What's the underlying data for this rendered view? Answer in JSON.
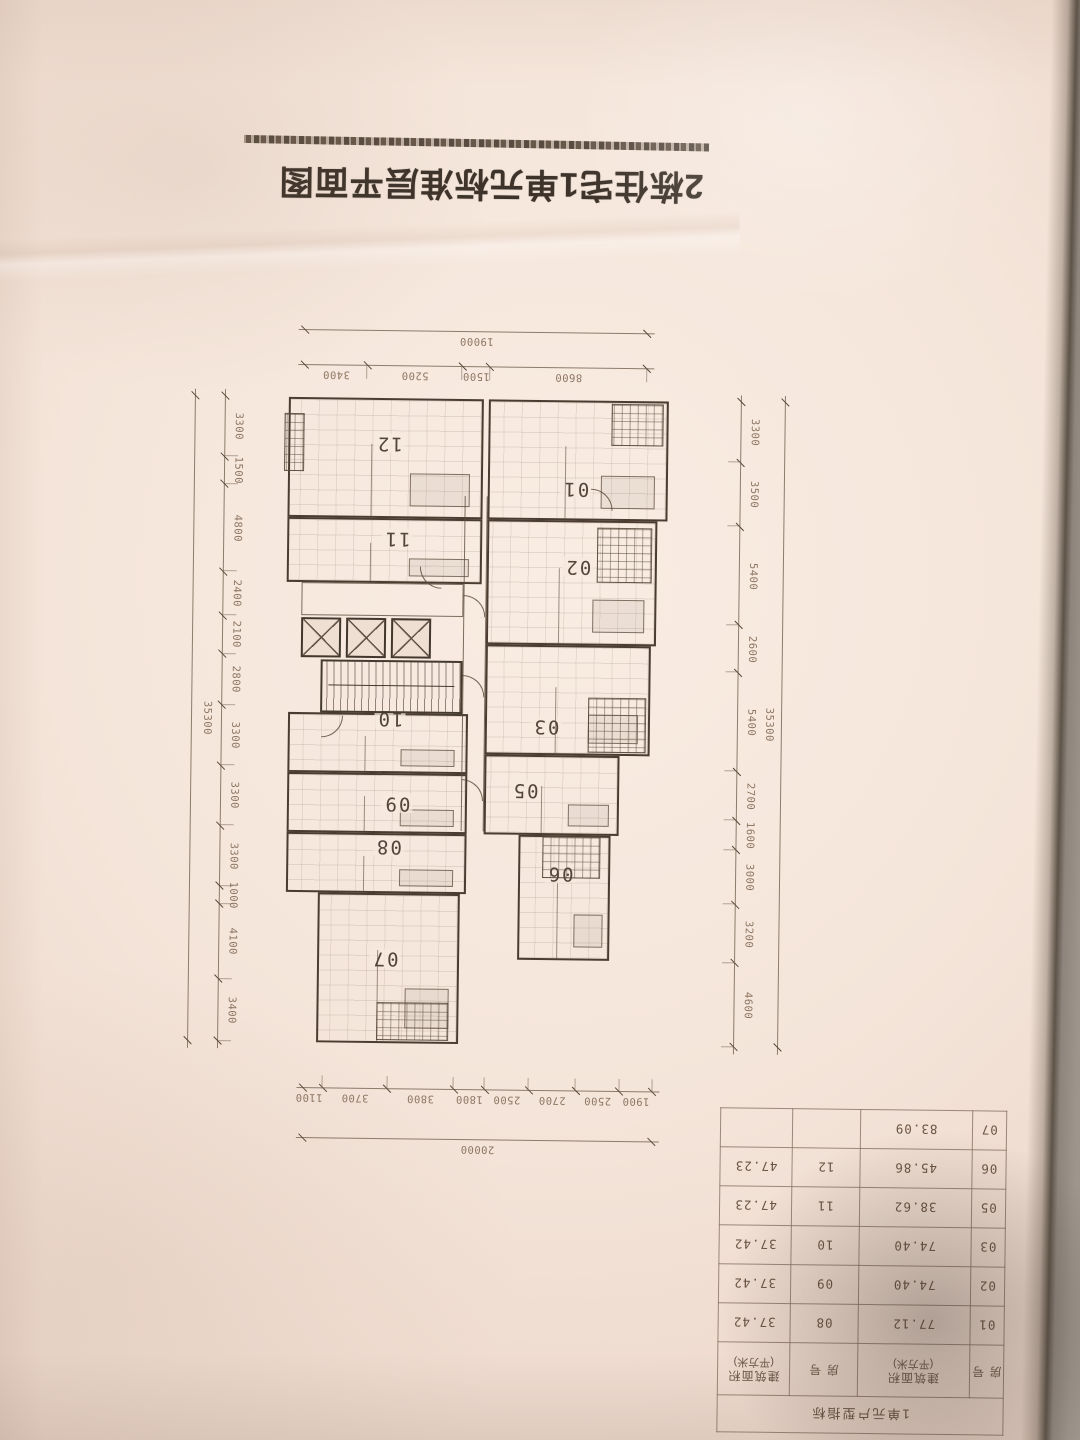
{
  "title": "2栋住宅1单元标准层平面图",
  "plan": {
    "units": [
      {
        "id": "u01",
        "label": "01"
      },
      {
        "id": "u02",
        "label": "02"
      },
      {
        "id": "u03",
        "label": "03"
      },
      {
        "id": "u05",
        "label": "05"
      },
      {
        "id": "u06",
        "label": "06"
      },
      {
        "id": "u07",
        "label": "07"
      },
      {
        "id": "u08",
        "label": "08"
      },
      {
        "id": "u09",
        "label": "09"
      },
      {
        "id": "u10",
        "label": "10"
      },
      {
        "id": "u11",
        "label": "11"
      },
      {
        "id": "u12",
        "label": "12"
      }
    ]
  },
  "dimensions": {
    "top": {
      "total": "20000",
      "segments": [
        "1900",
        "2500",
        "2700",
        "2500",
        "1800",
        "3800",
        "3700",
        "1100"
      ]
    },
    "bottom": {
      "total": "19000",
      "segments": [
        "8600",
        "1500",
        "5200",
        "3400"
      ]
    },
    "left": {
      "total": "35300",
      "segments": [
        "4600",
        "3200",
        "3000",
        "1600",
        "2700",
        "5400",
        "2600",
        "5400",
        "3500",
        "3300"
      ]
    },
    "right": {
      "total": "35300",
      "segments": [
        "3400",
        "4100",
        "1000",
        "3300",
        "3300",
        "3300",
        "2800",
        "2100",
        "2400",
        "4800",
        "1500",
        "3300"
      ]
    }
  },
  "table": {
    "title": "1单元户型指标",
    "headers": [
      "房 号",
      "建筑面积",
      "房 号",
      "建筑面积"
    ],
    "header_sub": "(平方米)",
    "rows": [
      [
        "01",
        "77.12",
        "08",
        "37.42"
      ],
      [
        "02",
        "74.40",
        "09",
        "37.42"
      ],
      [
        "03",
        "74.40",
        "10",
        "37.42"
      ],
      [
        "05",
        "38.62",
        "11",
        "47.23"
      ],
      [
        "06",
        "45.86",
        "12",
        "47.23"
      ],
      [
        "07",
        "83.09",
        "",
        ""
      ]
    ]
  },
  "colors": {
    "paper": "#f5e6db",
    "ink": "#3d332a",
    "wall": "#4a3c30",
    "dim_text": "#8d7663"
  }
}
